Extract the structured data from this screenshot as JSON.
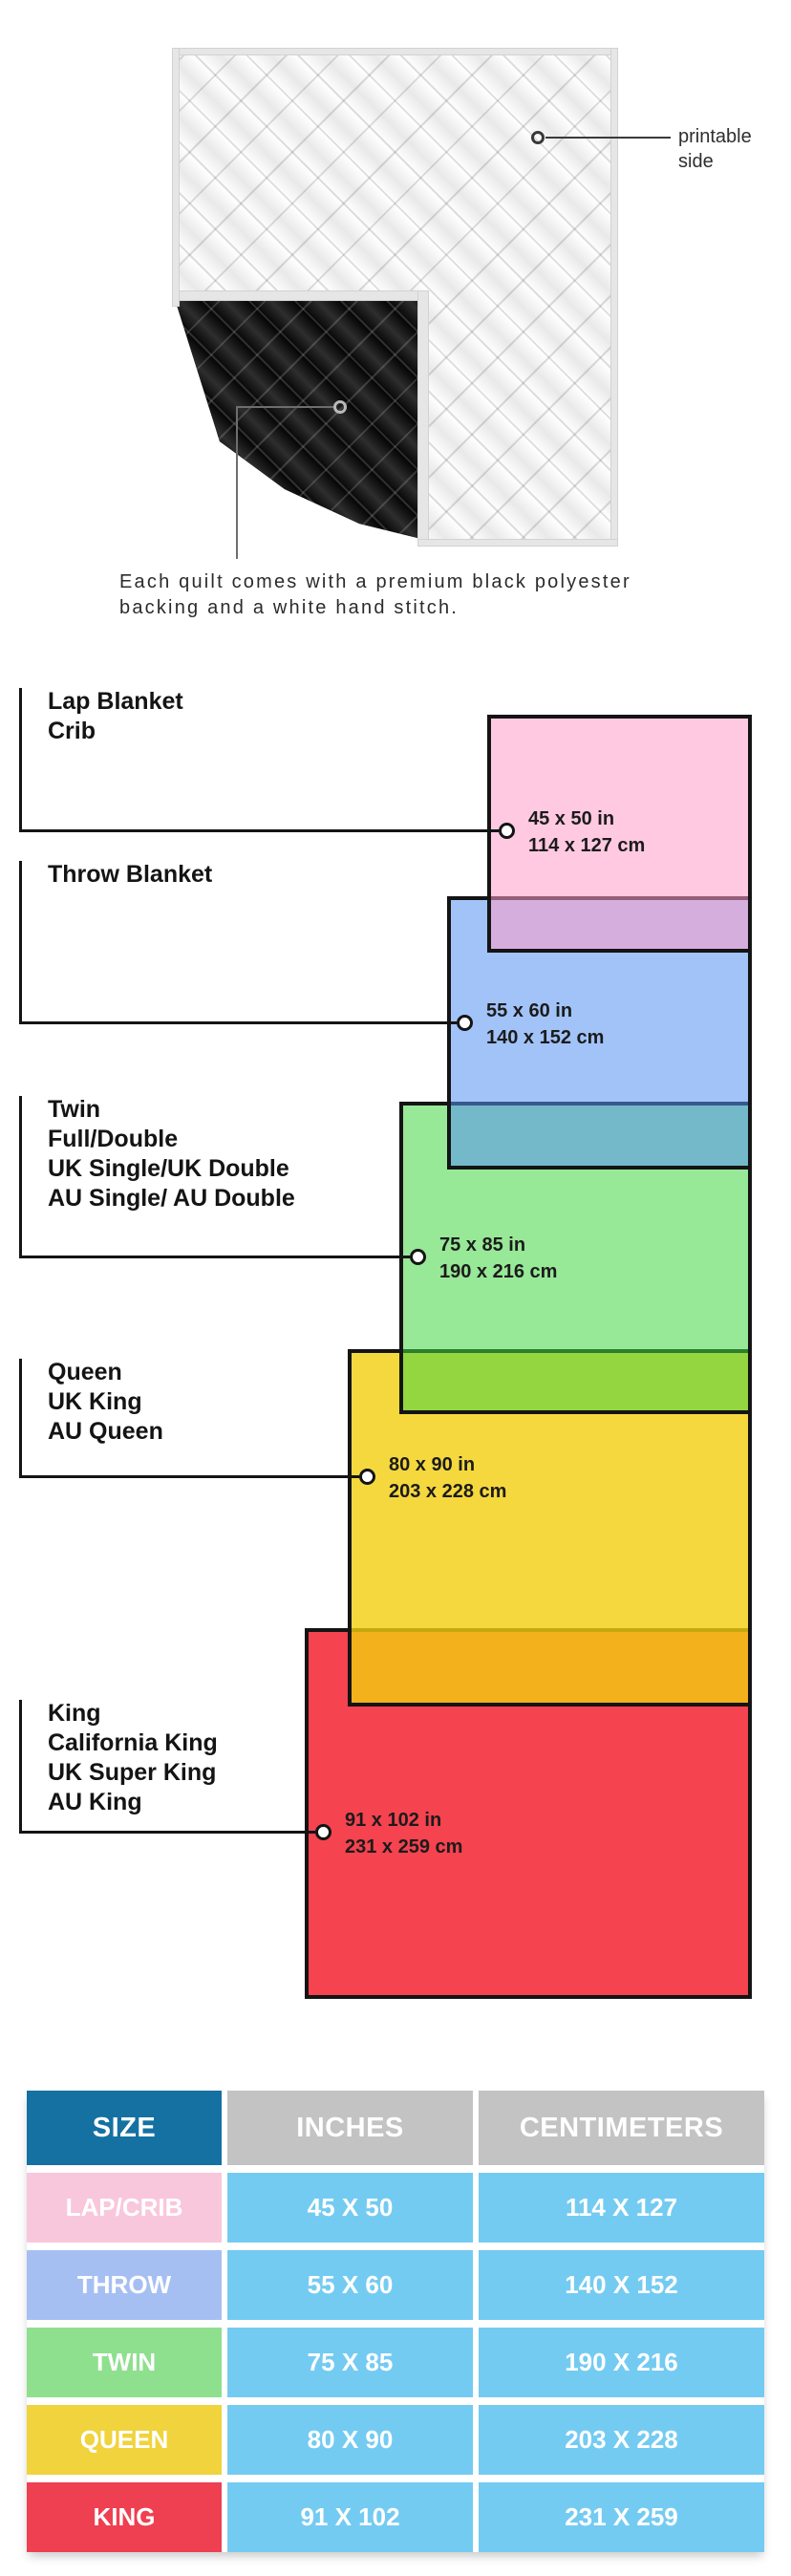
{
  "quilt": {
    "printable_label": {
      "line1": "printable",
      "line2": "side"
    },
    "caption_line1": "Each quilt comes with a premium black polyester",
    "caption_line2": "backing and a white hand stitch.",
    "front_color": "#f4f4f4",
    "backing_color": "#141414",
    "binding_color": "#e6e6e6"
  },
  "diagram": {
    "border_color": "#141414",
    "items": [
      {
        "id": "lap-crib",
        "labels": [
          "Lap Blanket",
          "Crib"
        ],
        "inches": "45 x 50 in",
        "centimeters": "114 x 127 cm",
        "fill": "#ffc9e1"
      },
      {
        "id": "throw",
        "labels": [
          "Throw Blanket"
        ],
        "inches": "55 x 60 in",
        "centimeters": "140 x 152 cm",
        "fill": "#a2c2f8"
      },
      {
        "id": "twin",
        "labels": [
          "Twin",
          "Full/Double",
          "UK Single/UK Double",
          "AU Single/ AU Double"
        ],
        "inches": "75 x 85 in",
        "centimeters": "190 x 216 cm",
        "fill": "#97e897"
      },
      {
        "id": "queen",
        "labels": [
          "Queen",
          "UK King",
          "AU Queen"
        ],
        "inches": "80 x 90 in",
        "centimeters": "203 x 228 cm",
        "fill": "#f5d83e"
      },
      {
        "id": "king",
        "labels": [
          "King",
          "California King",
          "UK Super King",
          "AU King"
        ],
        "inches": "91 x 102 in",
        "centimeters": "231 x 259 cm",
        "fill": "#f5434f"
      }
    ]
  },
  "table": {
    "headers": [
      "SIZE",
      "INCHES",
      "CENTIMETERS"
    ],
    "header_colors": {
      "size": "#1471a2",
      "others": "#c3c3c3"
    },
    "data_cell_color": "#74cbf2",
    "rows": [
      {
        "size": "LAP/CRIB",
        "inches": "45 X 50",
        "centimeters": "114 X 127",
        "color": "#f9c7dc"
      },
      {
        "size": "THROW",
        "inches": "55 X 60",
        "centimeters": "140 X 152",
        "color": "#a6bff3"
      },
      {
        "size": "TWIN",
        "inches": "75 X 85",
        "centimeters": "190 X 216",
        "color": "#8ee08e"
      },
      {
        "size": "QUEEN",
        "inches": "80 X 90",
        "centimeters": "203 X 228",
        "color": "#f0d33d"
      },
      {
        "size": "KING",
        "inches": "91 X 102",
        "centimeters": "231 X 259",
        "color": "#ee4051"
      }
    ]
  }
}
